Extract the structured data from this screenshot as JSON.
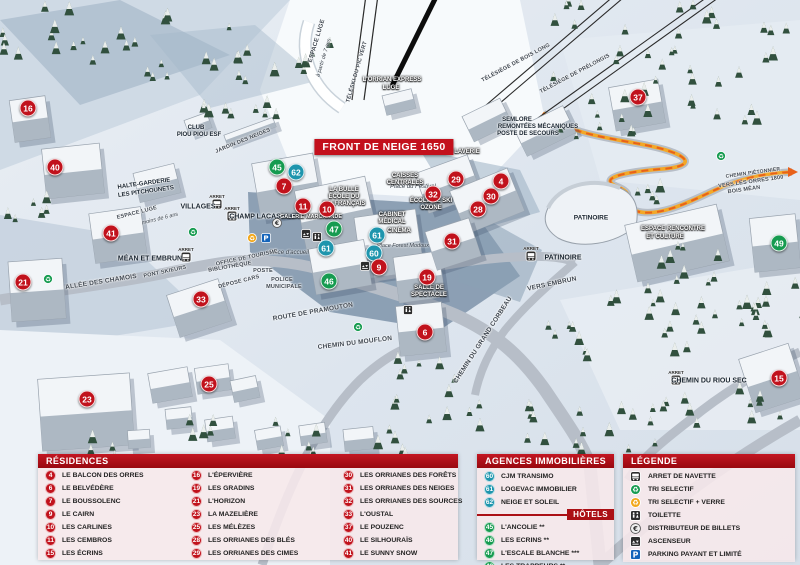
{
  "colors": {
    "red": "#c1121c",
    "teal": "#1e95ad",
    "green": "#169b50",
    "header_red": "#ab1015",
    "banner_red": "#c3101c",
    "orange_trail": "#e8611a",
    "parking_blue": "#1464ba",
    "recycle_orange": "#f2a71b",
    "recycle_green": "#169b50"
  },
  "map": {
    "banner": "FRONT DE NEIGE 1650",
    "stop_prefix": "ARRET",
    "markers": [
      {
        "n": "16",
        "x": 28,
        "y": 108,
        "c": "red"
      },
      {
        "n": "40",
        "x": 55,
        "y": 167,
        "c": "red"
      },
      {
        "n": "21",
        "x": 23,
        "y": 282,
        "c": "red"
      },
      {
        "n": "41",
        "x": 111,
        "y": 233,
        "c": "red"
      },
      {
        "n": "33",
        "x": 201,
        "y": 299,
        "c": "red"
      },
      {
        "n": "23",
        "x": 87,
        "y": 399,
        "c": "red"
      },
      {
        "n": "25",
        "x": 209,
        "y": 384,
        "c": "red"
      },
      {
        "n": "45",
        "x": 277,
        "y": 167,
        "c": "green"
      },
      {
        "n": "62",
        "x": 296,
        "y": 172,
        "c": "teal"
      },
      {
        "n": "7",
        "x": 284,
        "y": 186,
        "c": "red"
      },
      {
        "n": "11",
        "x": 303,
        "y": 206,
        "c": "red"
      },
      {
        "n": "10",
        "x": 327,
        "y": 209,
        "c": "red"
      },
      {
        "n": "47",
        "x": 334,
        "y": 229,
        "c": "green"
      },
      {
        "n": "61",
        "x": 326,
        "y": 248,
        "c": "teal"
      },
      {
        "n": "61",
        "x": 377,
        "y": 235,
        "c": "teal"
      },
      {
        "n": "60",
        "x": 374,
        "y": 253,
        "c": "teal"
      },
      {
        "n": "9",
        "x": 379,
        "y": 267,
        "c": "red"
      },
      {
        "n": "46",
        "x": 329,
        "y": 281,
        "c": "green"
      },
      {
        "n": "19",
        "x": 427,
        "y": 277,
        "c": "red"
      },
      {
        "n": "6",
        "x": 425,
        "y": 332,
        "c": "red"
      },
      {
        "n": "29",
        "x": 456,
        "y": 179,
        "c": "red"
      },
      {
        "n": "32",
        "x": 433,
        "y": 194,
        "c": "red"
      },
      {
        "n": "28",
        "x": 478,
        "y": 209,
        "c": "red"
      },
      {
        "n": "30",
        "x": 491,
        "y": 196,
        "c": "red"
      },
      {
        "n": "4",
        "x": 501,
        "y": 181,
        "c": "red"
      },
      {
        "n": "31",
        "x": 452,
        "y": 241,
        "c": "red"
      },
      {
        "n": "37",
        "x": 638,
        "y": 97,
        "c": "red"
      },
      {
        "n": "49",
        "x": 779,
        "y": 243,
        "c": "green"
      },
      {
        "n": "15",
        "x": 779,
        "y": 378,
        "c": "red"
      }
    ],
    "labels": [
      {
        "t": "ESPACE LUGE",
        "x": 317,
        "y": 41,
        "c": "road",
        "r": -73,
        "fs": 6
      },
      {
        "t": "à partir de 7 ans",
        "x": 324,
        "y": 58,
        "c": "place",
        "r": -73,
        "fs": 5.5
      },
      {
        "t": "TÉLÉSKI DU PIC VERT",
        "x": 357,
        "y": 72,
        "c": "road",
        "r": -74,
        "fs": 5.5
      },
      {
        "t": "L'ORRIAN EXPRESS",
        "x": 392,
        "y": 80,
        "c": "dark",
        "fs": 6
      },
      {
        "t": "LUGE",
        "x": 391,
        "y": 88,
        "c": "dark",
        "fs": 6
      },
      {
        "t": "TÉLÉSIÈGE DE BOIS LONG",
        "x": 516,
        "y": 63,
        "c": "road",
        "r": -28,
        "fs": 5.5
      },
      {
        "t": "TÉLÉSIÈGE DE PRÉLONGIS",
        "x": 575,
        "y": 74,
        "c": "road",
        "r": -28,
        "fs": 5.5
      },
      {
        "t": "SEMLORE",
        "x": 517,
        "y": 120,
        "c": "poi",
        "fs": 6
      },
      {
        "t": "REMONTÉES MÉCANIQUES",
        "x": 538,
        "y": 127,
        "c": "poi",
        "fs": 6
      },
      {
        "t": "POSTE DE SECOURS",
        "x": 528,
        "y": 134,
        "c": "poi",
        "fs": 6
      },
      {
        "t": "CLUB",
        "x": 196,
        "y": 128,
        "c": "poi",
        "fs": 6
      },
      {
        "t": "PIOU PIOU ESF",
        "x": 199,
        "y": 135,
        "c": "poi",
        "fs": 6
      },
      {
        "t": "JARDIN DES NEIGES",
        "x": 243,
        "y": 141,
        "c": "road",
        "r": -22,
        "fs": 5.5
      },
      {
        "t": "HALTE-GARDERIE",
        "x": 144,
        "y": 184,
        "c": "poi",
        "r": -8,
        "fs": 6
      },
      {
        "t": "LES PITCHOUNETS",
        "x": 146,
        "y": 192,
        "c": "poi",
        "r": -8,
        "fs": 6
      },
      {
        "t": "ESPACE LUGE",
        "x": 137,
        "y": 213,
        "c": "road",
        "r": -14,
        "fs": 5.5
      },
      {
        "t": "moins de 6 ans",
        "x": 160,
        "y": 219,
        "c": "place",
        "r": -14,
        "fs": 5.5
      },
      {
        "t": "LA BULLE",
        "x": 344,
        "y": 190,
        "c": "dark",
        "fs": 6
      },
      {
        "t": "ÉCOLE DU",
        "x": 344,
        "y": 197,
        "c": "dark",
        "fs": 6
      },
      {
        "t": "SKI FRANÇAIS",
        "x": 344,
        "y": 204,
        "c": "dark",
        "fs": 6
      },
      {
        "t": "Place du Festival",
        "x": 413,
        "y": 187,
        "c": "place"
      },
      {
        "t": "GALERIE MARCHANDE",
        "x": 311,
        "y": 217,
        "c": "dark",
        "fs": 5.5
      },
      {
        "t": "CAISSES",
        "x": 405,
        "y": 176,
        "c": "dark",
        "fs": 6
      },
      {
        "t": "CENTRALES",
        "x": 405,
        "y": 183,
        "c": "dark",
        "fs": 6
      },
      {
        "t": "LAVERIE",
        "x": 467,
        "y": 152,
        "c": "dark",
        "fs": 6
      },
      {
        "t": "ÉCOLE DE SKI",
        "x": 431,
        "y": 201,
        "c": "dark",
        "fs": 6
      },
      {
        "t": "OZONE",
        "x": 431,
        "y": 208,
        "c": "dark",
        "fs": 6
      },
      {
        "t": "CABINET",
        "x": 392,
        "y": 215,
        "c": "dark",
        "fs": 6
      },
      {
        "t": "MÉDICAL",
        "x": 392,
        "y": 222,
        "c": "dark",
        "fs": 6
      },
      {
        "t": "CINÉMA",
        "x": 399,
        "y": 231,
        "c": "dark",
        "fs": 6
      },
      {
        "t": "Place Forest Modoux",
        "x": 403,
        "y": 246,
        "c": "place",
        "fs": 5.5
      },
      {
        "t": "Place d'accueil",
        "x": 289,
        "y": 253,
        "c": "place"
      },
      {
        "t": "OFFICE DE TOURISME",
        "x": 247,
        "y": 258,
        "c": "road",
        "r": -12,
        "fs": 5.5
      },
      {
        "t": "BIBLIOTHÈQUE",
        "x": 230,
        "y": 267,
        "c": "road",
        "r": -10,
        "fs": 5.5
      },
      {
        "t": "POSTE",
        "x": 263,
        "y": 271,
        "c": "road",
        "fs": 5.5
      },
      {
        "t": "DÉPOSE CARS",
        "x": 239,
        "y": 282,
        "c": "road",
        "r": -14,
        "fs": 5.5
      },
      {
        "t": "POLICE",
        "x": 282,
        "y": 280,
        "c": "road",
        "fs": 5.5
      },
      {
        "t": "MUNICIPALE",
        "x": 284,
        "y": 287,
        "c": "road",
        "fs": 5.5
      },
      {
        "t": "SALLE DE",
        "x": 429,
        "y": 288,
        "c": "dark",
        "fs": 6
      },
      {
        "t": "SPECTACLE",
        "x": 429,
        "y": 295,
        "c": "dark",
        "fs": 6
      },
      {
        "t": "ALLÉE DES CHAMOIS",
        "x": 101,
        "y": 282,
        "c": "road",
        "r": -9
      },
      {
        "t": "PONT SKIEURS",
        "x": 165,
        "y": 272,
        "c": "road",
        "r": -12,
        "fs": 5.5
      },
      {
        "t": "ROUTE DE PRAMOUTON",
        "x": 313,
        "y": 312,
        "c": "road",
        "r": -10
      },
      {
        "t": "CHEMIN DU MOUFLON",
        "x": 355,
        "y": 343,
        "c": "road",
        "r": -7
      },
      {
        "t": "CHEMIN DU GRAND CORBEAU",
        "x": 483,
        "y": 340,
        "c": "road",
        "r": -57
      },
      {
        "t": "VERS EMBRUN",
        "x": 552,
        "y": 284,
        "c": "road",
        "r": -12
      },
      {
        "t": "PATINOIRE",
        "x": 591,
        "y": 218,
        "c": "poi",
        "fs": 6.5
      },
      {
        "t": "ESPACE RENCONTRE",
        "x": 673,
        "y": 229,
        "c": "dark",
        "fs": 6
      },
      {
        "t": "ET CULTURE",
        "x": 665,
        "y": 237,
        "c": "dark",
        "fs": 6
      },
      {
        "t": "CHEMIN PIÉTONNIER",
        "x": 753,
        "y": 173,
        "c": "road",
        "r": -8,
        "fs": 5
      },
      {
        "t": "VERS LES ORRES 1800",
        "x": 751,
        "y": 182,
        "c": "road",
        "r": -8,
        "fs": 5.5
      },
      {
        "t": "BOIS MÉAN",
        "x": 744,
        "y": 190,
        "c": "road",
        "r": -8,
        "fs": 5.5
      }
    ],
    "stops": [
      {
        "name": "VILLAGES",
        "nx": 198,
        "ny": 207,
        "ix": 217,
        "iy": 204
      },
      {
        "name": "CHAMP LACAS",
        "nx": 255,
        "ny": 217,
        "ix": 232,
        "iy": 216
      },
      {
        "name": "MÉAN ET EMBRUN",
        "nx": 150,
        "ny": 259,
        "ix": 186,
        "iy": 257
      },
      {
        "name": "PATINOIRE",
        "nx": 563,
        "ny": 258,
        "ix": 531,
        "iy": 256
      },
      {
        "name": "CHEMIN DU RIOU SEC",
        "nx": 709,
        "ny": 381,
        "ix": 676,
        "iy": 380
      }
    ],
    "icons": [
      {
        "type": "recycle-green",
        "x": 48,
        "y": 279
      },
      {
        "type": "recycle-green",
        "x": 193,
        "y": 232
      },
      {
        "type": "recycle-green",
        "x": 358,
        "y": 327
      },
      {
        "type": "recycle-green",
        "x": 721,
        "y": 156
      },
      {
        "type": "recycle-orange",
        "x": 252,
        "y": 238
      },
      {
        "type": "parking",
        "x": 266,
        "y": 238
      },
      {
        "type": "euro",
        "x": 277,
        "y": 223
      },
      {
        "type": "elevator",
        "x": 306,
        "y": 234
      },
      {
        "type": "elevator",
        "x": 365,
        "y": 266
      },
      {
        "type": "toilet",
        "x": 317,
        "y": 237
      },
      {
        "type": "toilet",
        "x": 408,
        "y": 310
      }
    ]
  },
  "panels": {
    "residences": {
      "title": "RÉSIDENCES",
      "items": [
        {
          "n": "4",
          "label": "LE BALCON DES ORRES"
        },
        {
          "n": "6",
          "label": "LE BELVÉDÈRE"
        },
        {
          "n": "7",
          "label": "LE BOUSSOLENC"
        },
        {
          "n": "9",
          "label": "LE CAIRN"
        },
        {
          "n": "10",
          "label": "LES CARLINES"
        },
        {
          "n": "11",
          "label": "LES CEMBROS"
        },
        {
          "n": "15",
          "label": "LES ÉCRINS"
        },
        {
          "n": "16",
          "label": "L'ÉPERVIÈRE"
        },
        {
          "n": "19",
          "label": "LES GRADINS"
        },
        {
          "n": "21",
          "label": "L'HORIZON"
        },
        {
          "n": "23",
          "label": "LA MAZELIÈRE"
        },
        {
          "n": "25",
          "label": "LES MÉLÈZES"
        },
        {
          "n": "28",
          "label": "LES ORRIANES DES BLÉS"
        },
        {
          "n": "29",
          "label": "LES ORRIANES DES CIMES"
        },
        {
          "n": "30",
          "label": "LES ORRIANES DES FORÊTS"
        },
        {
          "n": "31",
          "label": "LES ORRIANES DES NEIGES"
        },
        {
          "n": "32",
          "label": "LES ORRIANES DES SOURCES"
        },
        {
          "n": "33",
          "label": "L'OUSTAL"
        },
        {
          "n": "37",
          "label": "LE POUZENC"
        },
        {
          "n": "40",
          "label": "LE SILHOURAÏS"
        },
        {
          "n": "41",
          "label": "LE SUNNY SNOW"
        }
      ]
    },
    "agences": {
      "title": "AGENCES IMMOBILIÈRES",
      "items": [
        {
          "n": "60",
          "label": "CJM TRANSIMO"
        },
        {
          "n": "61",
          "label": "LOGEVAC IMMOBILIER"
        },
        {
          "n": "62",
          "label": "NEIGE ET SOLEIL"
        }
      ]
    },
    "hotels": {
      "title": "HÔTELS",
      "items": [
        {
          "n": "45",
          "label": "L'ANCOLIE **"
        },
        {
          "n": "46",
          "label": "LES ECRINS **"
        },
        {
          "n": "47",
          "label": "L'ESCALE BLANCHE ***"
        },
        {
          "n": "49",
          "label": "LES TRAPPEURS **"
        }
      ]
    },
    "legende": {
      "title": "LÉGENDE",
      "items": [
        {
          "icon": "bus",
          "label": "ARRET DE NAVETTE"
        },
        {
          "icon": "recycle-green",
          "label": "TRI SELECTIF"
        },
        {
          "icon": "recycle-orange",
          "label": "TRI SELECTIF + VERRE"
        },
        {
          "icon": "toilet",
          "label": "TOILETTE"
        },
        {
          "icon": "euro",
          "label": "DISTRIBUTEUR DE BILLETS"
        },
        {
          "icon": "elevator",
          "label": "ASCENSEUR"
        },
        {
          "icon": "parking",
          "label": "PARKING PAYANT ET LIMITÉ"
        }
      ]
    }
  }
}
